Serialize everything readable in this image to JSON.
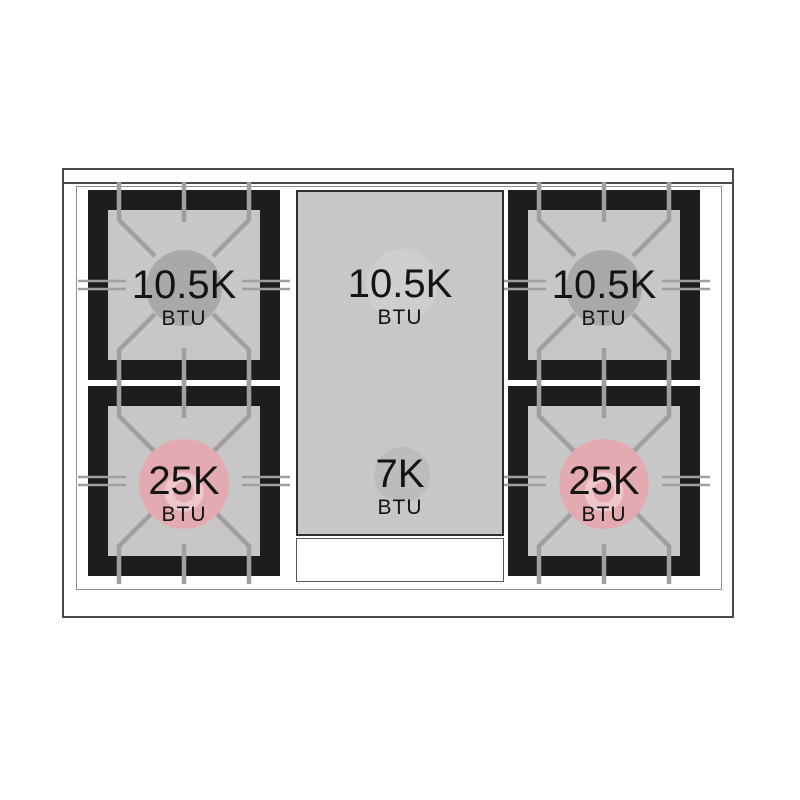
{
  "diagram_type": "range-cooktop-btu-diagram",
  "colors": {
    "frame_black": "#1d1d1d",
    "surface_gray": "#c7c7c7",
    "grate_line": "#9f9f9f",
    "standard_burner_gray": "#a9a9a9",
    "power_burner_pink": "#e3abb1",
    "power_burner_ring": "#efc8cd",
    "griddle_spot_light": "#cecece",
    "griddle_spot_dark": "#bcbcbc",
    "text": "#141414"
  },
  "burners": {
    "top_left": {
      "value": "10.5K",
      "unit": "BTU",
      "circle_color": "#a9a9a9"
    },
    "top_center": {
      "value": "10.5K",
      "unit": "BTU",
      "circle_color": "#cecece"
    },
    "top_right": {
      "value": "10.5K",
      "unit": "BTU",
      "circle_color": "#a9a9a9"
    },
    "bottom_left": {
      "value": "25K",
      "unit": "BTU",
      "circle_color": "#e3abb1"
    },
    "bottom_center": {
      "value": "7K",
      "unit": "BTU",
      "circle_color": "#bcbcbc"
    },
    "bottom_right": {
      "value": "25K",
      "unit": "BTU",
      "circle_color": "#e3abb1"
    }
  }
}
